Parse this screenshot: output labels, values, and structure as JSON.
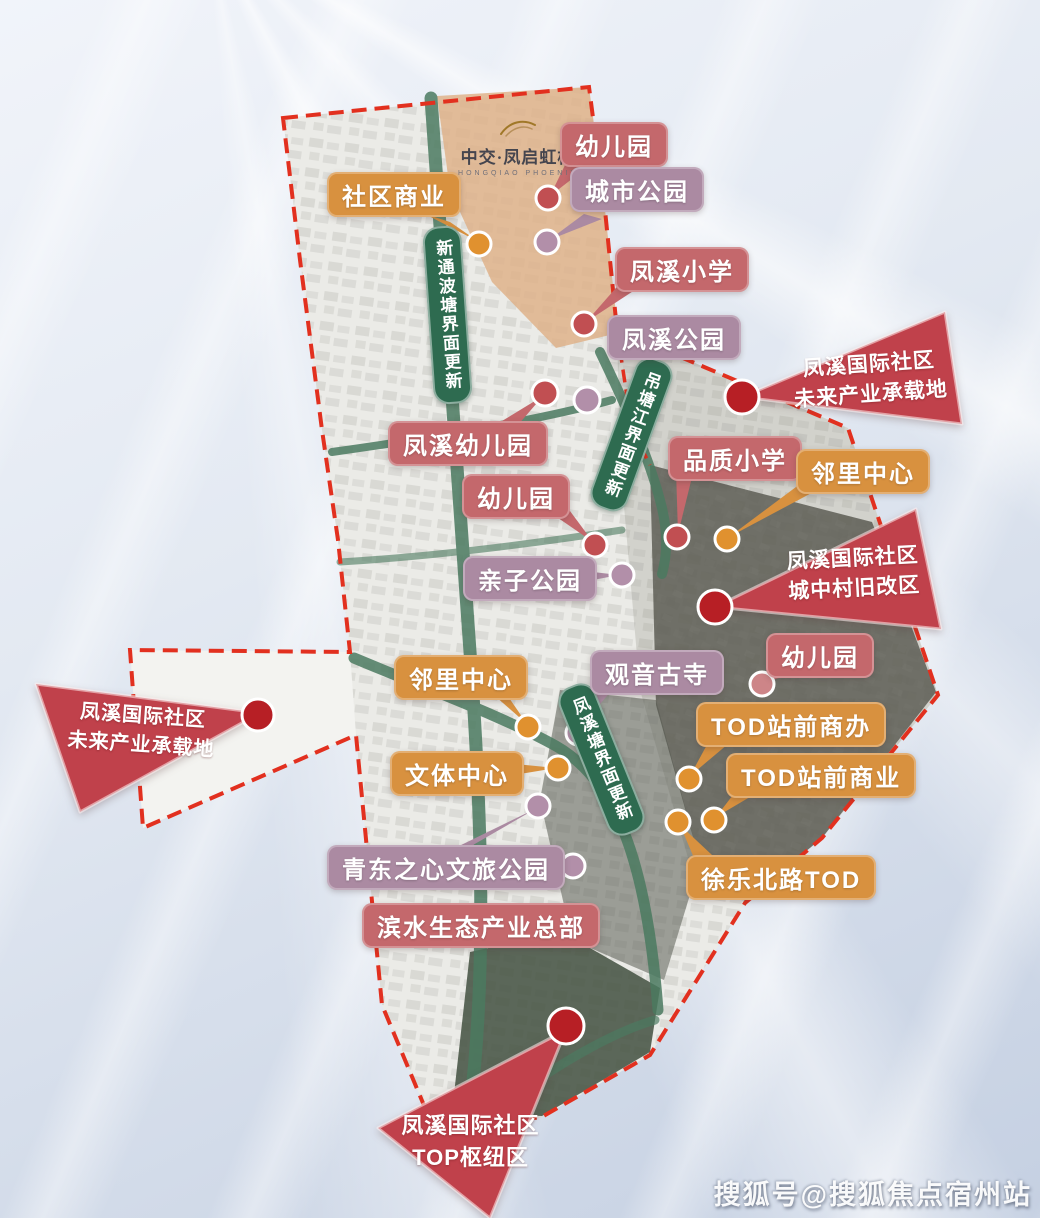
{
  "logo": {
    "title": "中交·凤启虹桥",
    "subtitle": "HONGQIAO PHOENIX"
  },
  "banners": [
    {
      "label": "新通波塘界面更新"
    },
    {
      "label": "吊塘江界面更新"
    },
    {
      "label": "凤溪塘界面更新"
    }
  ],
  "tags": [
    {
      "label": "社区商业",
      "type": "orange"
    },
    {
      "label": "幼儿园",
      "type": "red"
    },
    {
      "label": "城市公园",
      "type": "mauve"
    },
    {
      "label": "凤溪小学",
      "type": "red"
    },
    {
      "label": "凤溪公园",
      "type": "mauve"
    },
    {
      "label": "凤溪幼儿园",
      "type": "red"
    },
    {
      "label": "品质小学",
      "type": "red"
    },
    {
      "label": "邻里中心",
      "type": "orange"
    },
    {
      "label": "幼儿园",
      "type": "red"
    },
    {
      "label": "亲子公园",
      "type": "mauve"
    },
    {
      "label": "幼儿园",
      "type": "red"
    },
    {
      "label": "观音古寺",
      "type": "mauve"
    },
    {
      "label": "邻里中心",
      "type": "orange"
    },
    {
      "label": "TOD站前商办",
      "type": "orange"
    },
    {
      "label": "TOD站前商业",
      "type": "orange"
    },
    {
      "label": "文体中心",
      "type": "orange"
    },
    {
      "label": "青东之心文旅公园",
      "type": "mauve"
    },
    {
      "label": "徐乐北路TOD",
      "type": "orange"
    },
    {
      "label": "滨水生态产业总部",
      "type": "red"
    }
  ],
  "callouts": [
    {
      "line1": "凤溪国际社区",
      "line2": "未来产业承载地"
    },
    {
      "line1": "凤溪国际社区",
      "line2": "城中村旧改区"
    },
    {
      "line1": "凤溪国际社区",
      "line2": "未来产业承载地"
    },
    {
      "line1": "凤溪国际社区",
      "line2": "TOP枢纽区"
    }
  ],
  "watermark": "搜狐号@搜狐焦点宿州站",
  "colors": {
    "tag_red": "#c4686c",
    "tag_mauve": "#ab8aa2",
    "tag_orange": "#d8913f",
    "banner_green": "#2e6b50",
    "wedge_red": "#c0414b",
    "dot_dark_red": "#b71f25",
    "dot_red": "#c14f52",
    "dot_orange": "#e0912f",
    "dot_mauve": "#b28fa9",
    "dot_pink": "#cd8588",
    "border_red": "#e2301f",
    "map_green": "#4b7a60"
  }
}
